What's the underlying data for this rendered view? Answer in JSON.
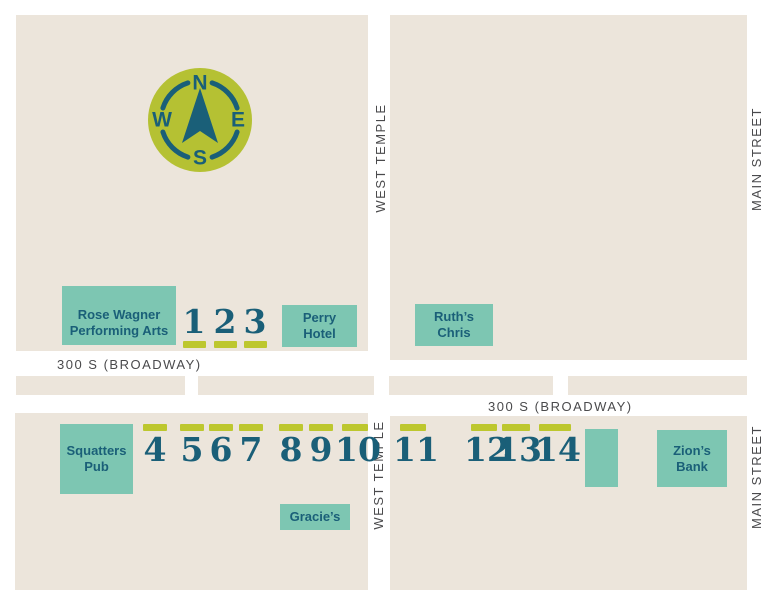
{
  "streets": {
    "broadway_left": "300 S (BROADWAY)",
    "broadway_right": "300 S (BROADWAY)",
    "west_temple_top": "WEST TEMPLE",
    "west_temple_bottom": "WEST TEMPLE",
    "main_street_top": "MAIN STREET",
    "main_street_bottom": "MAIN STREET"
  },
  "compass": {
    "n": "N",
    "e": "E",
    "s": "S",
    "w": "W"
  },
  "buildings": {
    "rose_wagner": {
      "line1": "Rose Wagner",
      "line2": "Performing Arts"
    },
    "perry_hotel": {
      "line1": "Perry",
      "line2": "Hotel"
    },
    "ruths_chris": {
      "line1": "Ruth’s",
      "line2": "Chris"
    },
    "squatters_pub": {
      "line1": "Squatters",
      "line2": "Pub"
    },
    "gracies": {
      "line1": "Gracie’s"
    },
    "zions_bank": {
      "line1": "Zion’s",
      "line2": "Bank"
    }
  },
  "markers": {
    "m1": "1",
    "m2": "2",
    "m3": "3",
    "m4": "4",
    "m5": "5",
    "m6": "6",
    "m7": "7",
    "m8": "8",
    "m9": "9",
    "m10": "10",
    "m11": "11",
    "m12": "12",
    "m13": "13",
    "m14": "14"
  },
  "colors": {
    "block": "#ECE5DB",
    "building": "#7DC6B2",
    "accent": "#BDC72E",
    "compass": "#B5C133",
    "dark_teal": "#1A5F78",
    "street_text": "#4A4A4C"
  }
}
